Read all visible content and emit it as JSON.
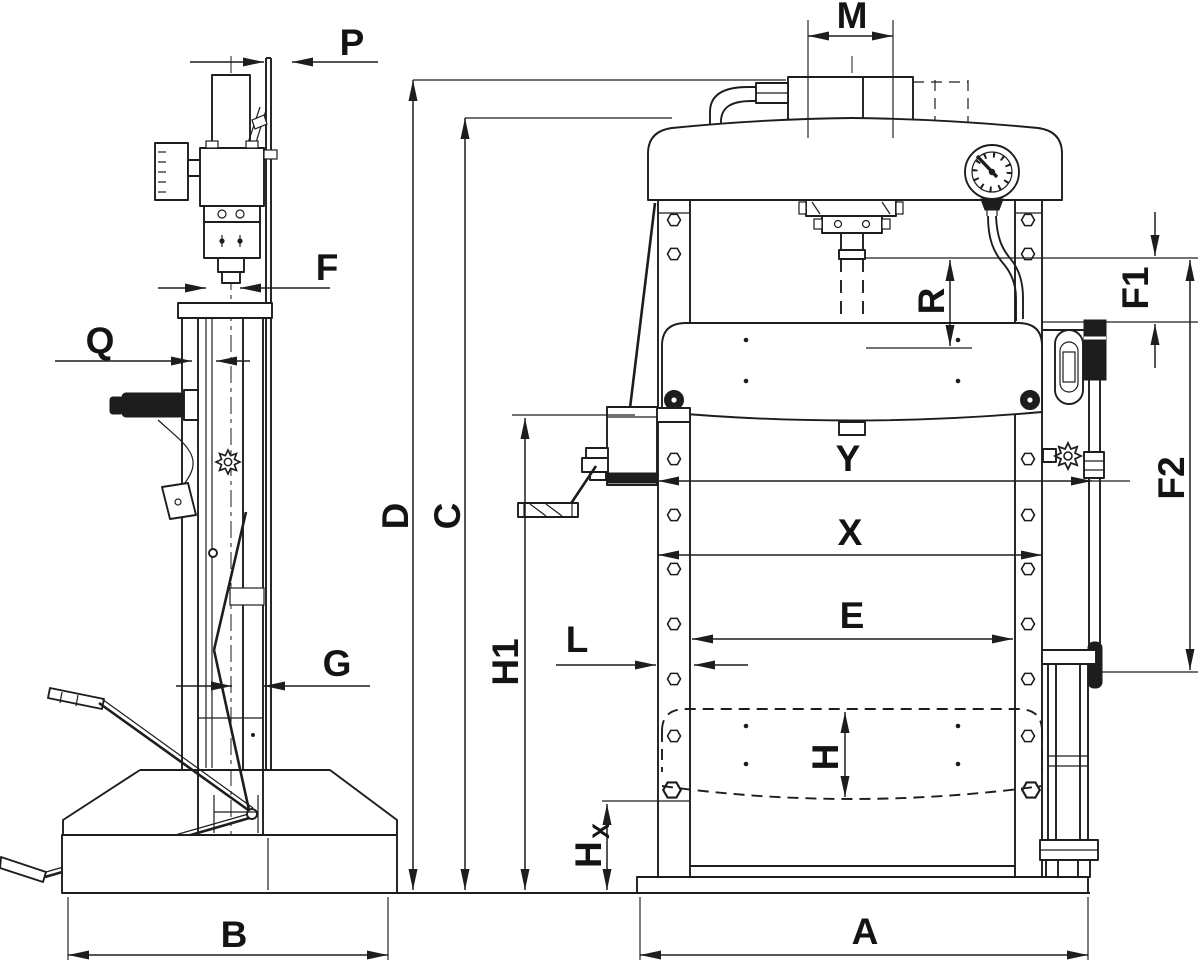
{
  "drawing": {
    "title": "Hydraulic workshop press - dimensional outline drawing",
    "background_color": "#ffffff",
    "line_color": "#1d1d1d",
    "views": [
      {
        "id": "side-view",
        "description": "left side profile of press with hand pump lever, release knob, foot pedal and base"
      },
      {
        "id": "front-view",
        "description": "front of press with crown, pressure gauge, ram, winch-operated table, hand pump and foot pedal"
      }
    ],
    "labels": {
      "P": "P",
      "M": "M",
      "F": "F",
      "Q": "Q",
      "D": "D",
      "C": "C",
      "H1": "H1",
      "G": "G",
      "B": "B",
      "L": "L",
      "E": "E",
      "X": "X",
      "Y": "Y",
      "R": "R",
      "F1": "F1",
      "F2": "F2",
      "H": "H",
      "Hx_main": "H",
      "Hx_sub": "X",
      "A": "A"
    }
  }
}
